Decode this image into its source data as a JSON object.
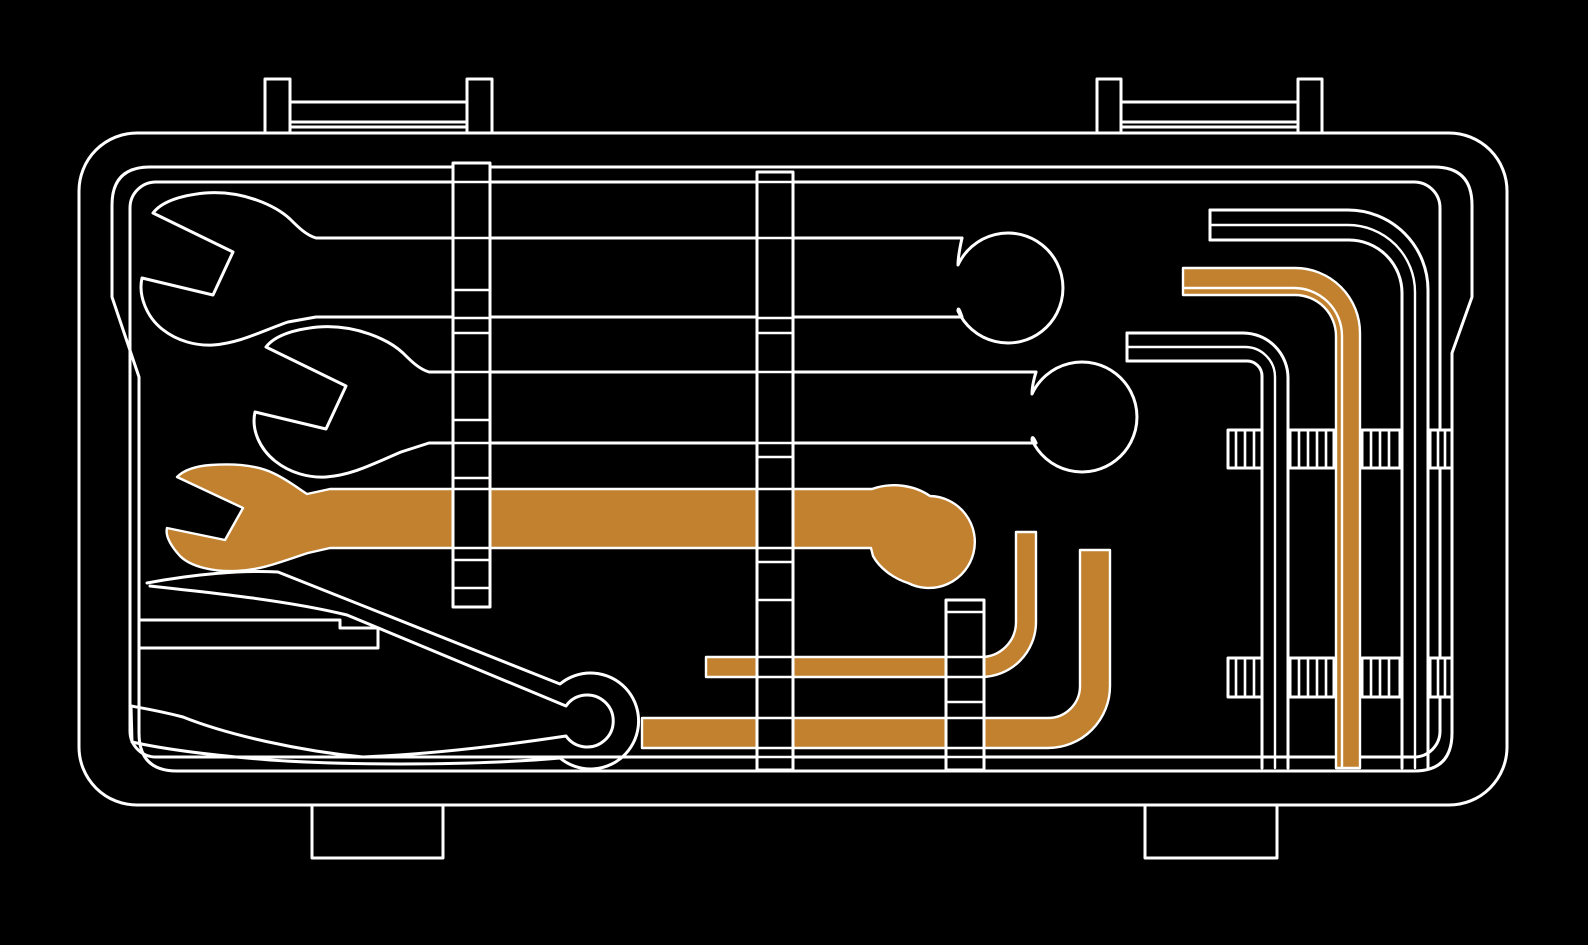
{
  "illustration": {
    "name": "car-tool-kit-case",
    "description": "Line-art illustration of an opened tool case containing wrenches and hex keys; one wrench and three hex keys highlighted in orange.",
    "colors": {
      "bg": "#000000",
      "line": "#FFFFFF",
      "accent": "#C1812F"
    },
    "items": [
      {
        "id": "case",
        "label": "tool case shell with carry handles and feet"
      },
      {
        "id": "wrench-1",
        "label": "open-end wrench (white outline, top)"
      },
      {
        "id": "wrench-2",
        "label": "open-end wrench (white outline, middle)"
      },
      {
        "id": "wrench-3",
        "label": "open-end wrench (orange highlighted)"
      },
      {
        "id": "wedge-tool",
        "label": "wedge / pry tool (white outline)"
      },
      {
        "id": "hex-key-white-1",
        "label": "L-hex key (white outline, large)"
      },
      {
        "id": "hex-key-white-2",
        "label": "L-hex key (white outline, medium)"
      },
      {
        "id": "hex-key-orange-small",
        "label": "L-hex key (orange, small)"
      },
      {
        "id": "hex-key-orange-medium",
        "label": "L-hex key (orange, medium)"
      },
      {
        "id": "hex-key-orange-tall",
        "label": "L-hex key (orange, tall)"
      },
      {
        "id": "straps",
        "label": "retention straps"
      }
    ]
  }
}
